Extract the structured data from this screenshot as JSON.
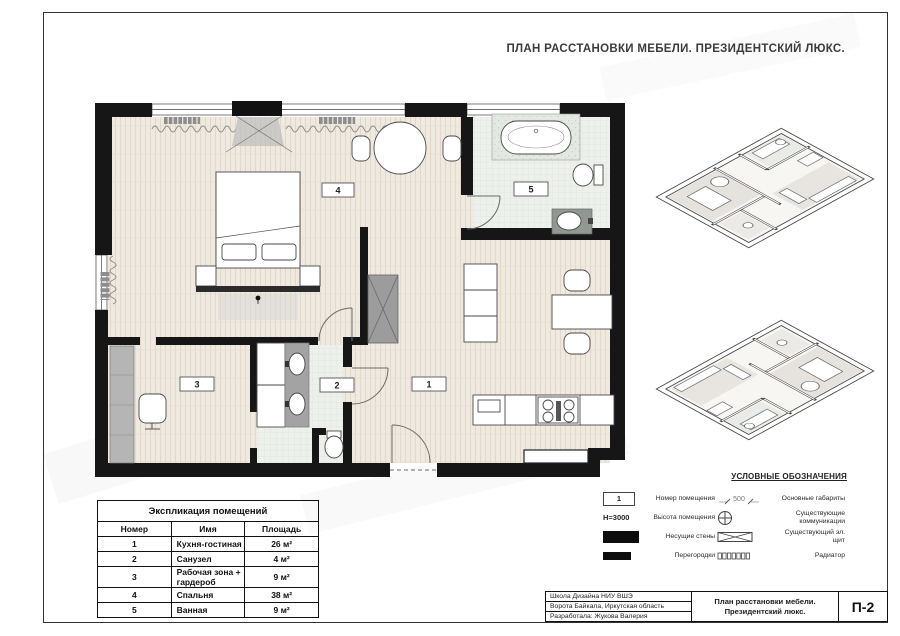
{
  "header": {
    "title": "ПЛАН РАССТАНОВКИ МЕБЕЛИ. ПРЕЗИДЕНТСКИЙ ЛЮКС."
  },
  "plan": {
    "room_labels": {
      "r1": "1",
      "r2": "2",
      "r3": "3",
      "r4": "4",
      "r5": "5"
    }
  },
  "legend": {
    "title": "УСЛОВНЫЕ ОБОЗНАЧЕНИЯ",
    "room_number_symbol": "1",
    "height_symbol": "H=3000",
    "dimension_symbol": "500",
    "items": [
      {
        "label": "Номер помещения"
      },
      {
        "label": "Высота помещения"
      },
      {
        "label": "Несущие стены"
      },
      {
        "label": "Перегородки"
      },
      {
        "label": "Основные габариты"
      },
      {
        "label": "Существующие коммуникации"
      },
      {
        "label": "Существующий эл. щит"
      },
      {
        "label": "Радиатор"
      }
    ]
  },
  "table": {
    "title": "Экспликация помещений",
    "headers": [
      "Номер",
      "Имя",
      "Площадь"
    ],
    "rows": [
      {
        "num": "1",
        "name": "Кухня-гостиная",
        "area": "26 м²"
      },
      {
        "num": "2",
        "name": "Санузел",
        "area": "4 м²"
      },
      {
        "num": "3",
        "name": "Рабочая зона + гардероб",
        "area": "9 м²"
      },
      {
        "num": "4",
        "name": "Спальня",
        "area": "38 м²"
      },
      {
        "num": "5",
        "name": "Ванная",
        "area": "9 м²"
      }
    ]
  },
  "title_block": {
    "org_lines": [
      "Школа Дизайна НИУ ВШЭ",
      "Ворота Байкала, Иркутская область",
      "Разработала: Жукова Валерия"
    ],
    "doc_title": [
      "План расстановки мебели.",
      "Президентский люкс."
    ],
    "sheet_code": "П-2"
  },
  "colors": {
    "wall": "#161616",
    "counter_gray": "#a3a3a3",
    "tile": "#edf0ea",
    "wood": "#efe9e0"
  }
}
